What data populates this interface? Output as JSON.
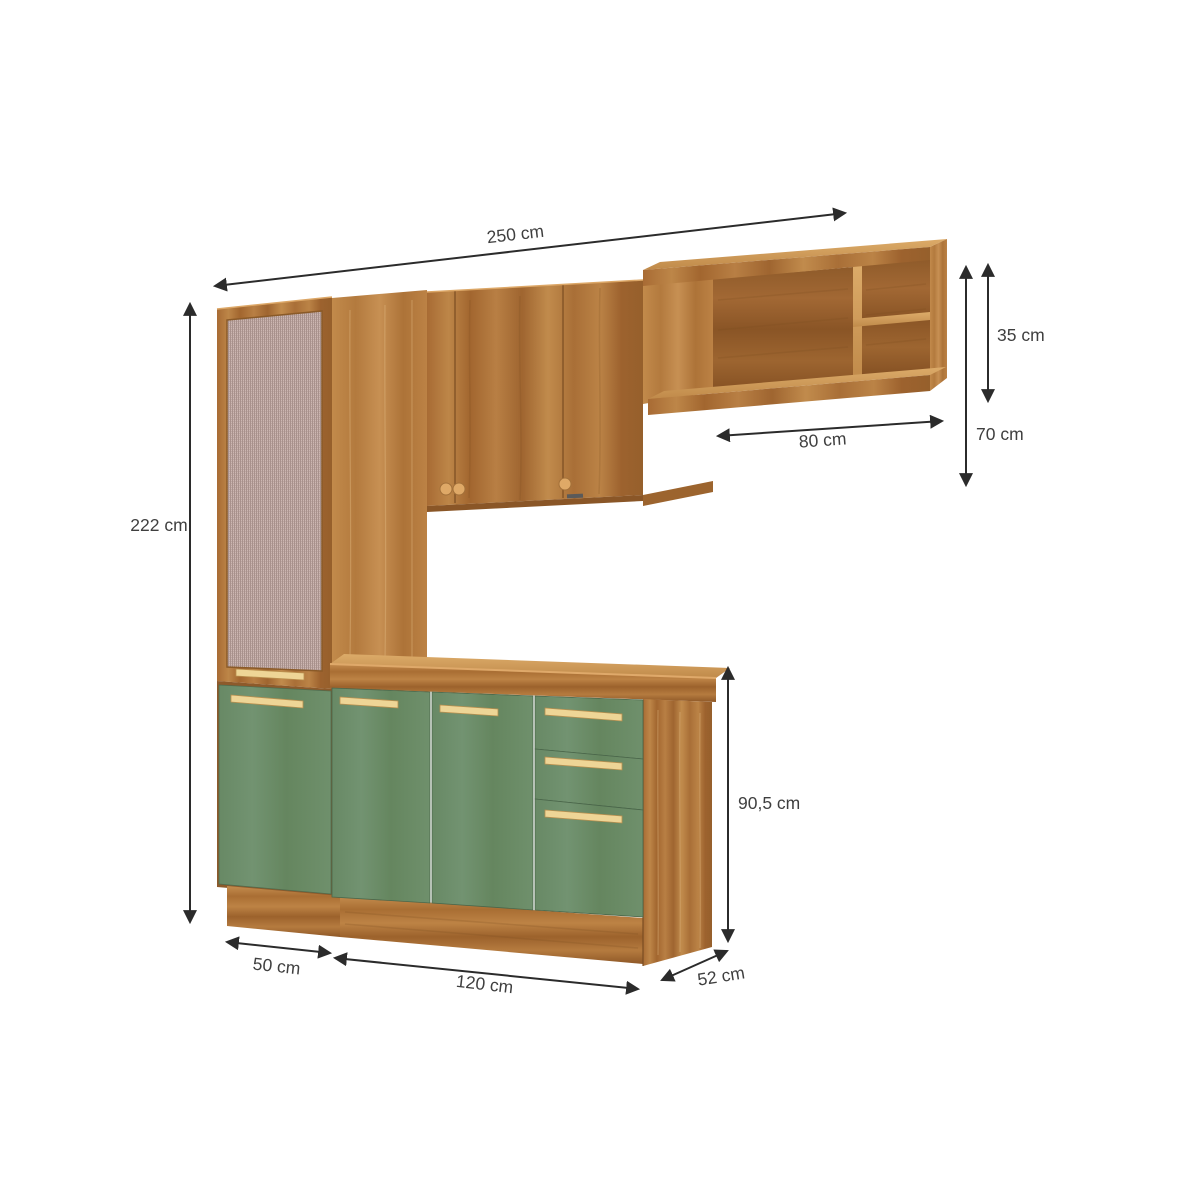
{
  "page": {
    "background": "#ffffff",
    "type": "product dimension diagram",
    "subject": "modular kitchen cabinet set with hutch, wall cabinets, open niche and base unit"
  },
  "dims": {
    "total_width": "250 cm",
    "total_height": "222 cm",
    "hutch_compartment_height": "35 cm",
    "wall_unit_height": "70 cm",
    "niche_width": "80 cm",
    "base_unit_height": "90,5 cm",
    "left_cabinet_width": "50 cm",
    "base_cabinet_width": "120 cm",
    "depth": "52 cm"
  },
  "colors": {
    "wood": "#b07438",
    "wood_dark": "#8d5a2b",
    "wood_light": "#cf9a58",
    "green_front": "#6f906c",
    "handle": "#eed596",
    "mesh_screen": "#bca6a1",
    "dimension_line": "#2b2b2b",
    "label_text": "#3f3f3f",
    "background": "#ffffff"
  },
  "parts": {
    "tall_cabinet": "tall cabinet with woven-screen door and green lower door",
    "wall_cabinet": "two-door wall cabinet with knobs",
    "open_niche": "open niche with shelf",
    "hutch_shelf_unit": "right open shelf unit with divider",
    "base_cabinet": "base cabinet with two green doors, two drawers and lower door",
    "countertop": "wood countertop",
    "plinth": "wood plinth base"
  }
}
